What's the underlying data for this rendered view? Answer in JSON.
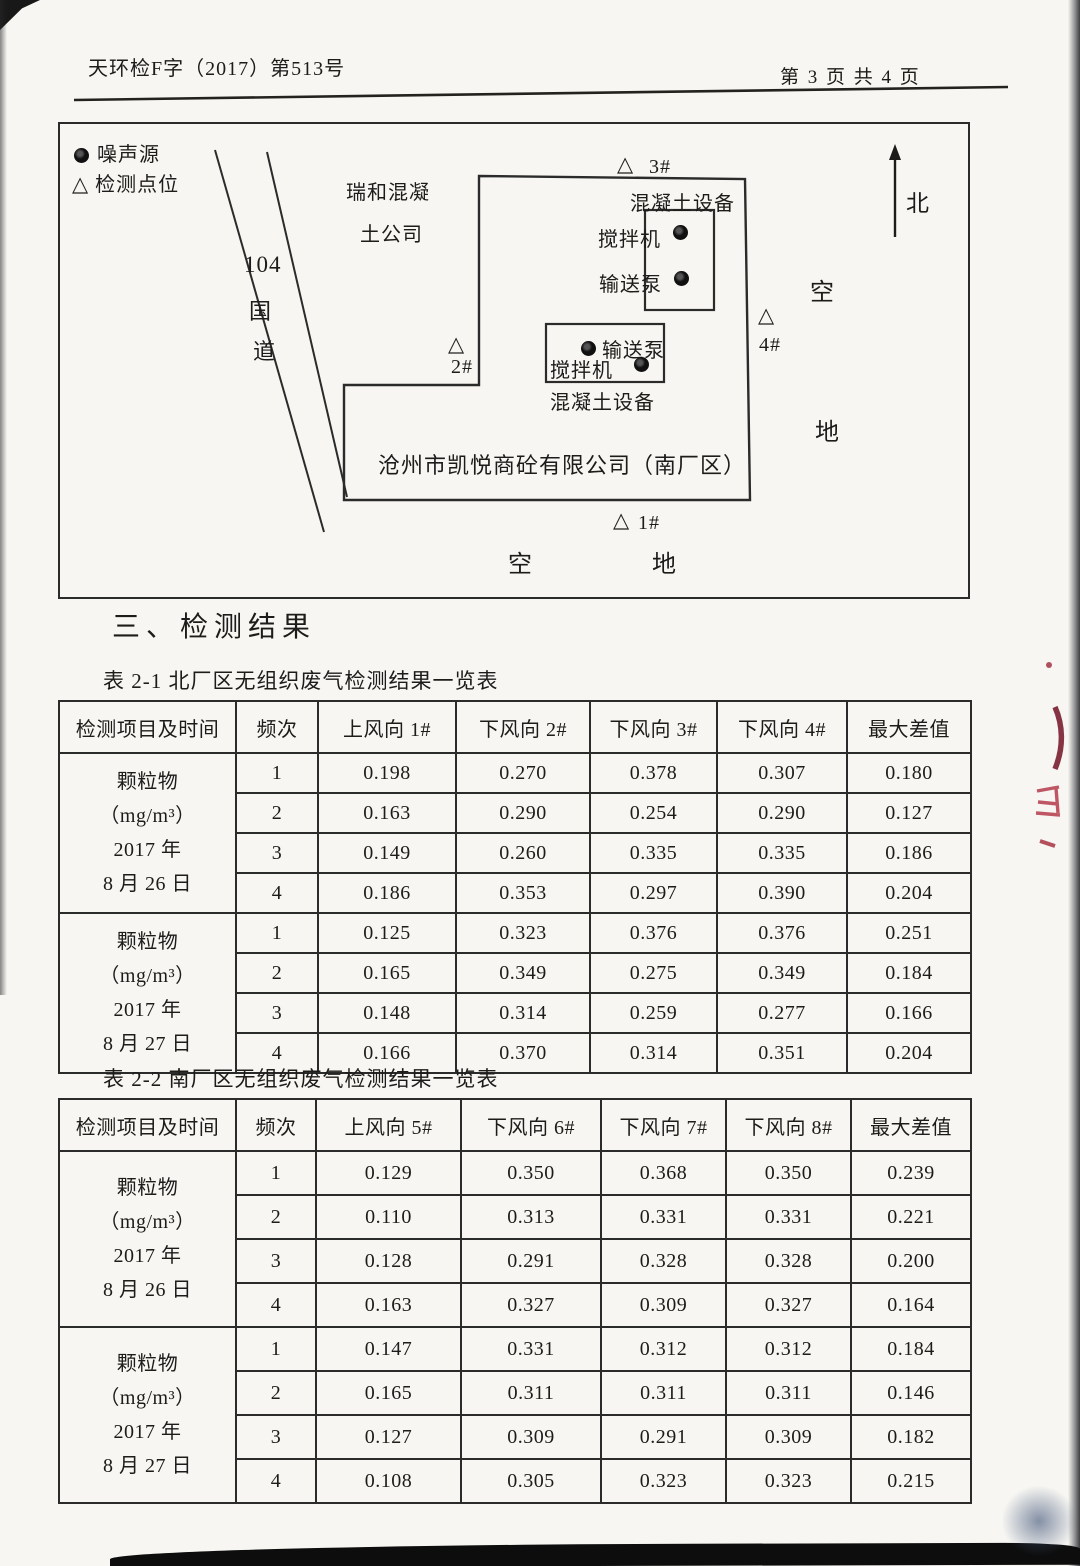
{
  "colors": {
    "paper": "#f7f6f2",
    "ink": "#1d1c1a",
    "table_line": "#2b2b2b",
    "red_ink_mark": "#a23345",
    "edge_shadow": "#14161c"
  },
  "header": {
    "doc_number": "天环检F字（2017）第513号",
    "page_label": "第 3 页 共 4 页"
  },
  "section_title": "三、检测结果",
  "diagram": {
    "legend": {
      "noise_label": "噪声源",
      "point_label": "检测点位"
    },
    "road": {
      "number": "104",
      "char1": "国",
      "char2": "道"
    },
    "neighbor": {
      "line1": "瑞和混凝",
      "line2": "土公司"
    },
    "north_label": "北",
    "company_label": "沧州市凯悦商砼有限公司（南厂区）",
    "north_area": {
      "equipment": "混凝土设备",
      "mixer": "搅拌机",
      "pump": "输送泵"
    },
    "south_area": {
      "equipment": "混凝土设备",
      "mixer": "搅拌机",
      "pump": "输送泵"
    },
    "points": {
      "p1": "1#",
      "p2": "2#",
      "p3": "3#",
      "p4": "4#"
    },
    "empty_right": {
      "char1": "空",
      "char2": "地"
    },
    "empty_bottom": {
      "char1": "空",
      "char2": "地"
    }
  },
  "table1": {
    "caption": "表 2-1 北厂区无组织废气检测结果一览表",
    "headers": [
      "检测项目及时间",
      "频次",
      "上风向 1#",
      "下风向 2#",
      "下风向 3#",
      "下风向 4#",
      "最大差值"
    ],
    "groups": [
      {
        "item_lines": [
          "颗粒物",
          "（mg/m³）",
          "2017 年",
          "8 月 26 日"
        ],
        "rows": [
          [
            "1",
            "0.198",
            "0.270",
            "0.378",
            "0.307",
            "0.180"
          ],
          [
            "2",
            "0.163",
            "0.290",
            "0.254",
            "0.290",
            "0.127"
          ],
          [
            "3",
            "0.149",
            "0.260",
            "0.335",
            "0.335",
            "0.186"
          ],
          [
            "4",
            "0.186",
            "0.353",
            "0.297",
            "0.390",
            "0.204"
          ]
        ]
      },
      {
        "item_lines": [
          "颗粒物",
          "（mg/m³）",
          "2017 年",
          "8 月 27 日"
        ],
        "rows": [
          [
            "1",
            "0.125",
            "0.323",
            "0.376",
            "0.376",
            "0.251"
          ],
          [
            "2",
            "0.165",
            "0.349",
            "0.275",
            "0.349",
            "0.184"
          ],
          [
            "3",
            "0.148",
            "0.314",
            "0.259",
            "0.277",
            "0.166"
          ],
          [
            "4",
            "0.166",
            "0.370",
            "0.314",
            "0.351",
            "0.204"
          ]
        ]
      }
    ]
  },
  "table2": {
    "caption": "表 2-2 南厂区无组织废气检测结果一览表",
    "headers": [
      "检测项目及时间",
      "频次",
      "上风向 5#",
      "下风向 6#",
      "下风向 7#",
      "下风向 8#",
      "最大差值"
    ],
    "groups": [
      {
        "item_lines": [
          "颗粒物",
          "（mg/m³）",
          "2017 年",
          "8 月 26 日"
        ],
        "rows": [
          [
            "1",
            "0.129",
            "0.350",
            "0.368",
            "0.350",
            "0.239"
          ],
          [
            "2",
            "0.110",
            "0.313",
            "0.331",
            "0.331",
            "0.221"
          ],
          [
            "3",
            "0.128",
            "0.291",
            "0.328",
            "0.328",
            "0.200"
          ],
          [
            "4",
            "0.163",
            "0.327",
            "0.309",
            "0.327",
            "0.164"
          ]
        ]
      },
      {
        "item_lines": [
          "颗粒物",
          "（mg/m³）",
          "2017 年",
          "8 月 27 日"
        ],
        "rows": [
          [
            "1",
            "0.147",
            "0.331",
            "0.312",
            "0.312",
            "0.184"
          ],
          [
            "2",
            "0.165",
            "0.311",
            "0.311",
            "0.311",
            "0.146"
          ],
          [
            "3",
            "0.127",
            "0.309",
            "0.291",
            "0.309",
            "0.182"
          ],
          [
            "4",
            "0.108",
            "0.305",
            "0.323",
            "0.323",
            "0.215"
          ]
        ]
      }
    ]
  }
}
